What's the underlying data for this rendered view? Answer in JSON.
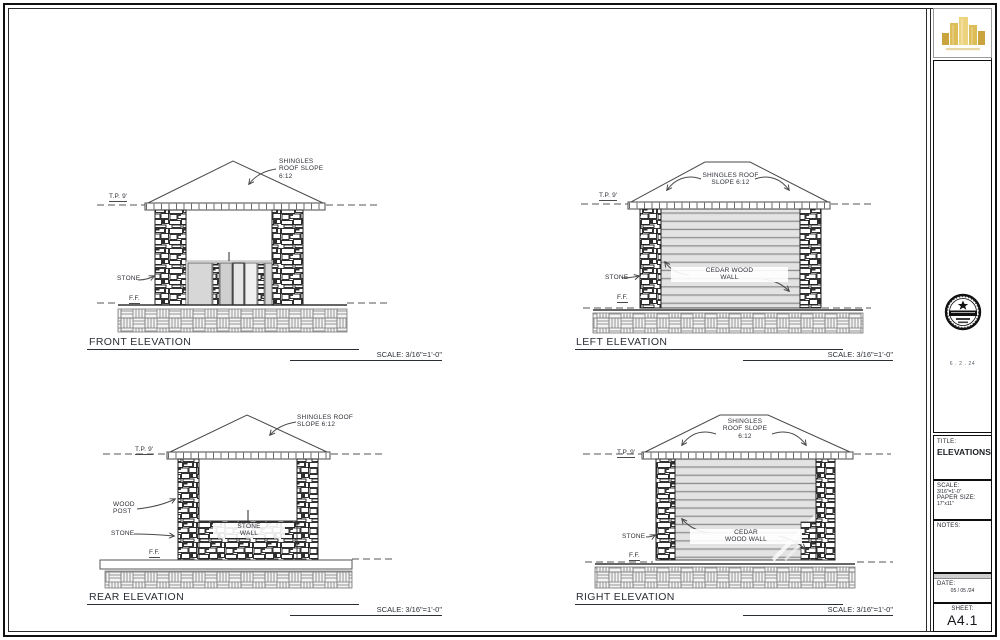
{
  "colors": {
    "ink": "#3a3a3a",
    "gold": "#d9b84f"
  },
  "elevations": {
    "front": {
      "name": "FRONT ELEVATION",
      "scale_note": "SCALE: 3/16\"=1'-0\"",
      "tp": "T.P. 9'",
      "ff": "F.F.",
      "stone": "STONE",
      "roof_note": [
        "SHINGLES",
        "ROOF SLOPE",
        "6:12"
      ]
    },
    "left": {
      "name": "LEFT ELEVATION",
      "scale_note": "SCALE: 3/16\"=1'-0\"",
      "tp": "T.P. 9'",
      "ff": "F.F.",
      "stone": "STONE",
      "roof_note": [
        "SHINGLES ROOF",
        "SLOPE 6:12"
      ],
      "wall_note": [
        "CEDAR WOOD",
        "WALL"
      ]
    },
    "rear": {
      "name": "REAR ELEVATION",
      "scale_note": "SCALE: 3/16\"=1'-0\"",
      "tp": "T.P. 9'",
      "ff": "F.F.",
      "stone": "STONE",
      "roof_note": [
        "SHINGLES ROOF",
        "SLOPE 6:12"
      ],
      "post_note": [
        "WOOD",
        "POST"
      ],
      "wall_note": [
        "STONE",
        "WALL"
      ]
    },
    "right": {
      "name": "RIGHT ELEVATION",
      "scale_note": "SCALE: 3/16\"=1'-0\"",
      "tp": "T.P. 9'",
      "ff": "F.F.",
      "stone": "STONE",
      "roof_note": [
        "SHINGLES",
        "ROOF SLOPE",
        "6:12"
      ],
      "wall_note": [
        "CEDAR",
        "WOOD WALL"
      ]
    }
  },
  "titleblock": {
    "seal_date": "6 . 2 . 24",
    "title_label": "TITLE:",
    "title_value": "ELEVATIONS",
    "scale_label": "SCALE:",
    "scale_value": "3/16\"=1'-0\"",
    "paper_label": "PAPER SIZE:",
    "paper_value": "17\"x11\"",
    "notes_label": "NOTES:",
    "date_label": "DATE:",
    "date_value": "05 / 05 /24",
    "sheet_label": "SHEET:",
    "sheet_value": "A4.1"
  }
}
